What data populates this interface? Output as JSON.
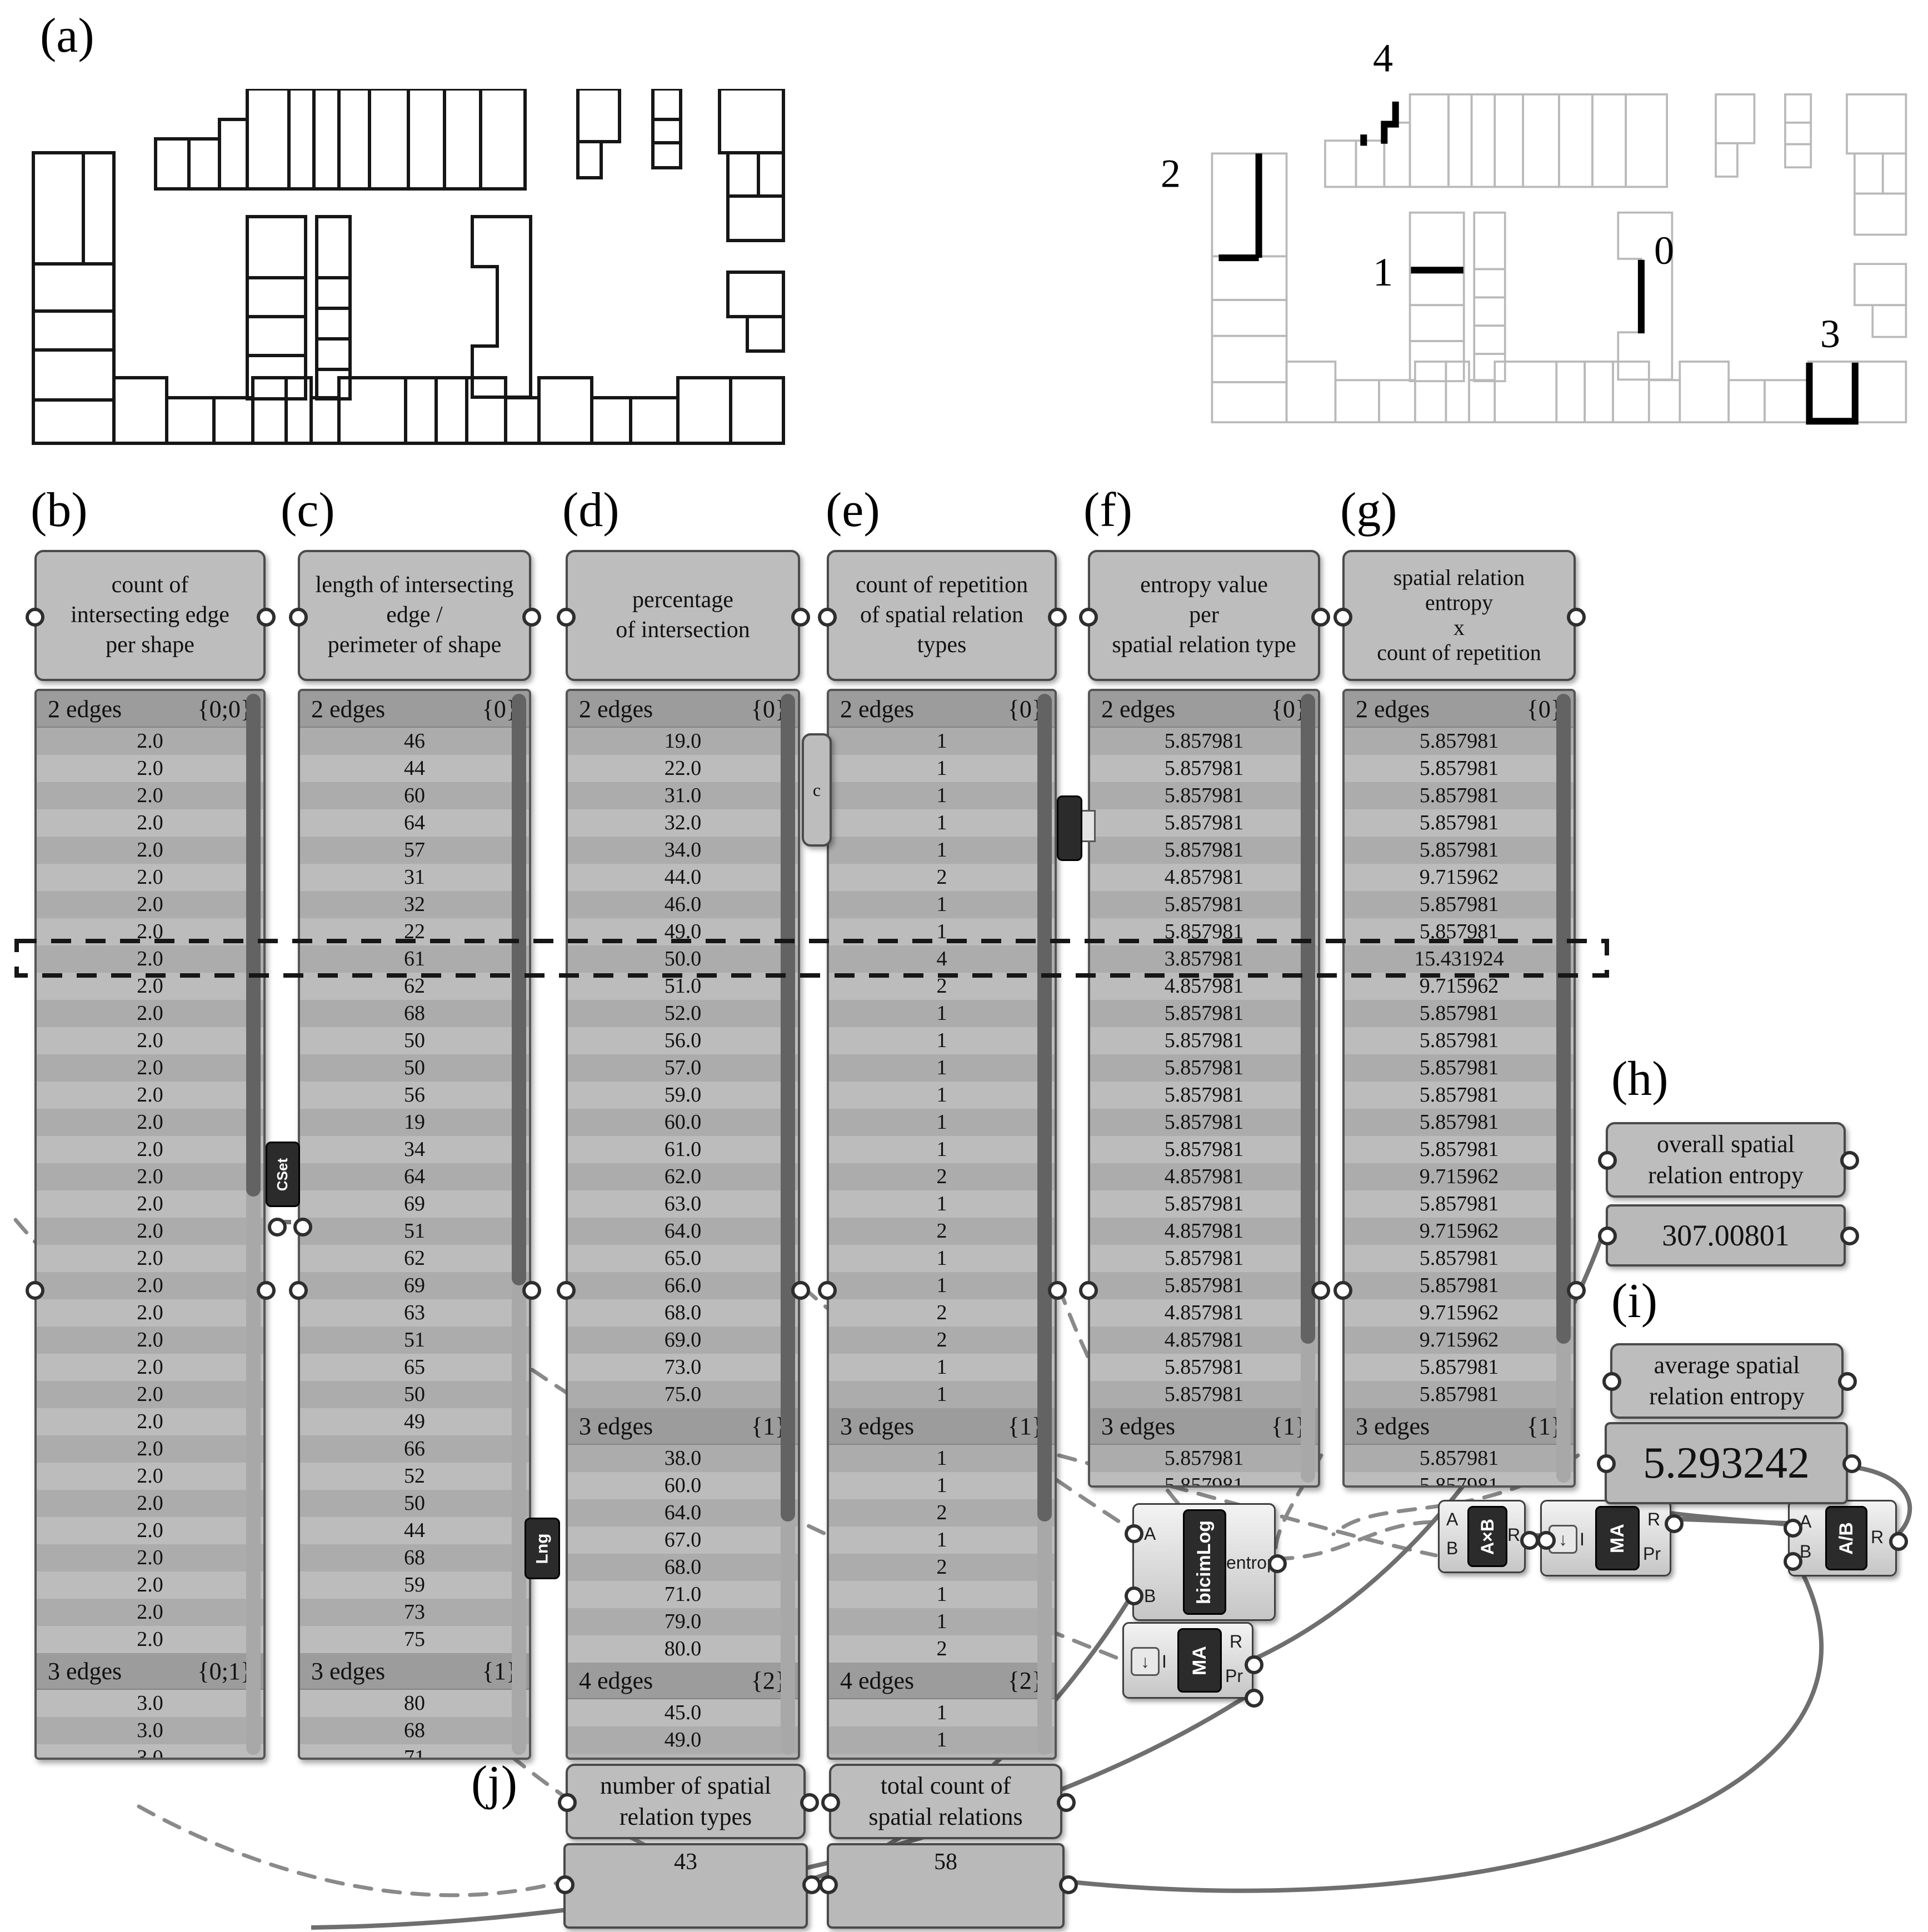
{
  "figure_labels": {
    "a": "(a)",
    "b": "(b)",
    "c": "(c)",
    "d": "(d)",
    "e": "(e)",
    "f": "(f)",
    "g": "(g)",
    "h": "(h)",
    "i": "(i)",
    "j": "(j)"
  },
  "plan": {
    "highlights": [
      {
        "label": "0"
      },
      {
        "label": "1"
      },
      {
        "label": "2"
      },
      {
        "label": "3"
      },
      {
        "label": "4"
      }
    ]
  },
  "columns": [
    {
      "id": "b",
      "title": "count of\nintersecting edge\nper shape",
      "groups": [
        {
          "name": "2 edges",
          "path": "{0;0}",
          "values": [
            "2.0",
            "2.0",
            "2.0",
            "2.0",
            "2.0",
            "2.0",
            "2.0",
            "2.0",
            "2.0",
            "2.0",
            "2.0",
            "2.0",
            "2.0",
            "2.0",
            "2.0",
            "2.0",
            "2.0",
            "2.0",
            "2.0",
            "2.0",
            "2.0",
            "2.0",
            "2.0",
            "2.0",
            "2.0",
            "2.0",
            "2.0",
            "2.0",
            "2.0",
            "2.0",
            "2.0",
            "2.0",
            "2.0",
            "2.0"
          ]
        },
        {
          "name": "3 edges",
          "path": "{0;1}",
          "values": [
            "3.0",
            "3.0",
            "3.0"
          ]
        }
      ]
    },
    {
      "id": "c",
      "title": "length of intersecting\nedge /\nperimeter of shape",
      "groups": [
        {
          "name": "2 edges",
          "path": "{0}",
          "values": [
            "46",
            "44",
            "60",
            "64",
            "57",
            "31",
            "32",
            "22",
            "61",
            "62",
            "68",
            "50",
            "50",
            "56",
            "19",
            "34",
            "64",
            "69",
            "51",
            "62",
            "69",
            "63",
            "51",
            "65",
            "50",
            "49",
            "66",
            "52",
            "50",
            "44",
            "68",
            "59",
            "73",
            "75"
          ]
        },
        {
          "name": "3 edges",
          "path": "{1}",
          "values": [
            "80",
            "68",
            "71"
          ]
        }
      ]
    },
    {
      "id": "d",
      "title": "percentage\nof intersection",
      "groups": [
        {
          "name": "2 edges",
          "path": "{0}",
          "values": [
            "19.0",
            "22.0",
            "31.0",
            "32.0",
            "34.0",
            "44.0",
            "46.0",
            "49.0",
            "50.0",
            "51.0",
            "52.0",
            "56.0",
            "57.0",
            "59.0",
            "60.0",
            "61.0",
            "62.0",
            "63.0",
            "64.0",
            "65.0",
            "66.0",
            "68.0",
            "69.0",
            "73.0",
            "75.0"
          ]
        },
        {
          "name": "3 edges",
          "path": "{1}",
          "values": [
            "38.0",
            "60.0",
            "64.0",
            "67.0",
            "68.0",
            "71.0",
            "79.0",
            "80.0"
          ]
        },
        {
          "name": "4 edges",
          "path": "{2}",
          "values": [
            "45.0",
            "49.0"
          ]
        }
      ]
    },
    {
      "id": "e",
      "title": "count of repetition\nof spatial relation\ntypes",
      "groups": [
        {
          "name": "2 edges",
          "path": "{0}",
          "values": [
            "1",
            "1",
            "1",
            "1",
            "1",
            "2",
            "1",
            "1",
            "4",
            "2",
            "1",
            "1",
            "1",
            "1",
            "1",
            "1",
            "2",
            "1",
            "2",
            "1",
            "1",
            "2",
            "2",
            "1",
            "1"
          ]
        },
        {
          "name": "3 edges",
          "path": "{1}",
          "values": [
            "1",
            "1",
            "2",
            "1",
            "2",
            "1",
            "1",
            "2"
          ]
        },
        {
          "name": "4 edges",
          "path": "{2}",
          "values": [
            "1",
            "1"
          ]
        }
      ]
    },
    {
      "id": "f",
      "title": "entropy value\nper\nspatial relation type",
      "groups": [
        {
          "name": "2 edges",
          "path": "{0}",
          "values": [
            "5.857981",
            "5.857981",
            "5.857981",
            "5.857981",
            "5.857981",
            "4.857981",
            "5.857981",
            "5.857981",
            "3.857981",
            "4.857981",
            "5.857981",
            "5.857981",
            "5.857981",
            "5.857981",
            "5.857981",
            "5.857981",
            "4.857981",
            "5.857981",
            "4.857981",
            "5.857981",
            "5.857981",
            "4.857981",
            "4.857981",
            "5.857981",
            "5.857981"
          ]
        },
        {
          "name": "3 edges",
          "path": "{1}",
          "values": [
            "5.857981",
            "5.857981"
          ]
        }
      ]
    },
    {
      "id": "g",
      "title": "spatial relation\nentropy\nx\ncount of repetition",
      "groups": [
        {
          "name": "2 edges",
          "path": "{0}",
          "values": [
            "5.857981",
            "5.857981",
            "5.857981",
            "5.857981",
            "5.857981",
            "9.715962",
            "5.857981",
            "5.857981",
            "15.431924",
            "9.715962",
            "5.857981",
            "5.857981",
            "5.857981",
            "5.857981",
            "5.857981",
            "5.857981",
            "9.715962",
            "5.857981",
            "9.715962",
            "5.857981",
            "5.857981",
            "9.715962",
            "9.715962",
            "5.857981",
            "5.857981"
          ]
        },
        {
          "name": "3 edges",
          "path": "{1}",
          "values": [
            "5.857981",
            "5.857981"
          ]
        }
      ]
    }
  ],
  "outputs": {
    "overall": {
      "title": "overall spatial\nrelation entropy",
      "value": "307.00801"
    },
    "average": {
      "title": "average spatial\nrelation entropy",
      "value": "5.293242"
    },
    "types": {
      "title": "number of spatial\nrelation types",
      "value": "43"
    },
    "total": {
      "title": "total count of\nspatial relations",
      "value": "58"
    }
  },
  "components": [
    {
      "id": "cset",
      "tag": "CSet",
      "inputs": [],
      "outputs": []
    },
    {
      "id": "cparam",
      "tag": "c",
      "inputs": [],
      "outputs": []
    },
    {
      "id": "hidden",
      "tag": "",
      "inputs": [],
      "outputs": []
    },
    {
      "id": "lng",
      "tag": "Lng",
      "inputs": [],
      "outputs": []
    },
    {
      "id": "bicimlog",
      "tag": "bicimLog",
      "inputs": [
        "A",
        "B"
      ],
      "outputs": [
        "entropy"
      ]
    },
    {
      "id": "ma1",
      "tag": "MA",
      "inputs": [
        "I"
      ],
      "outputs": [
        "R",
        "Pr"
      ]
    },
    {
      "id": "ma2",
      "tag": "MA",
      "inputs": [
        "I"
      ],
      "outputs": [
        "R",
        "Pr"
      ]
    },
    {
      "id": "axb",
      "tag": "A×B",
      "inputs": [
        "A",
        "B"
      ],
      "outputs": [
        "R"
      ]
    },
    {
      "id": "adb",
      "tag": "A/B",
      "inputs": [
        "A",
        "B"
      ],
      "outputs": [
        "R"
      ]
    }
  ]
}
